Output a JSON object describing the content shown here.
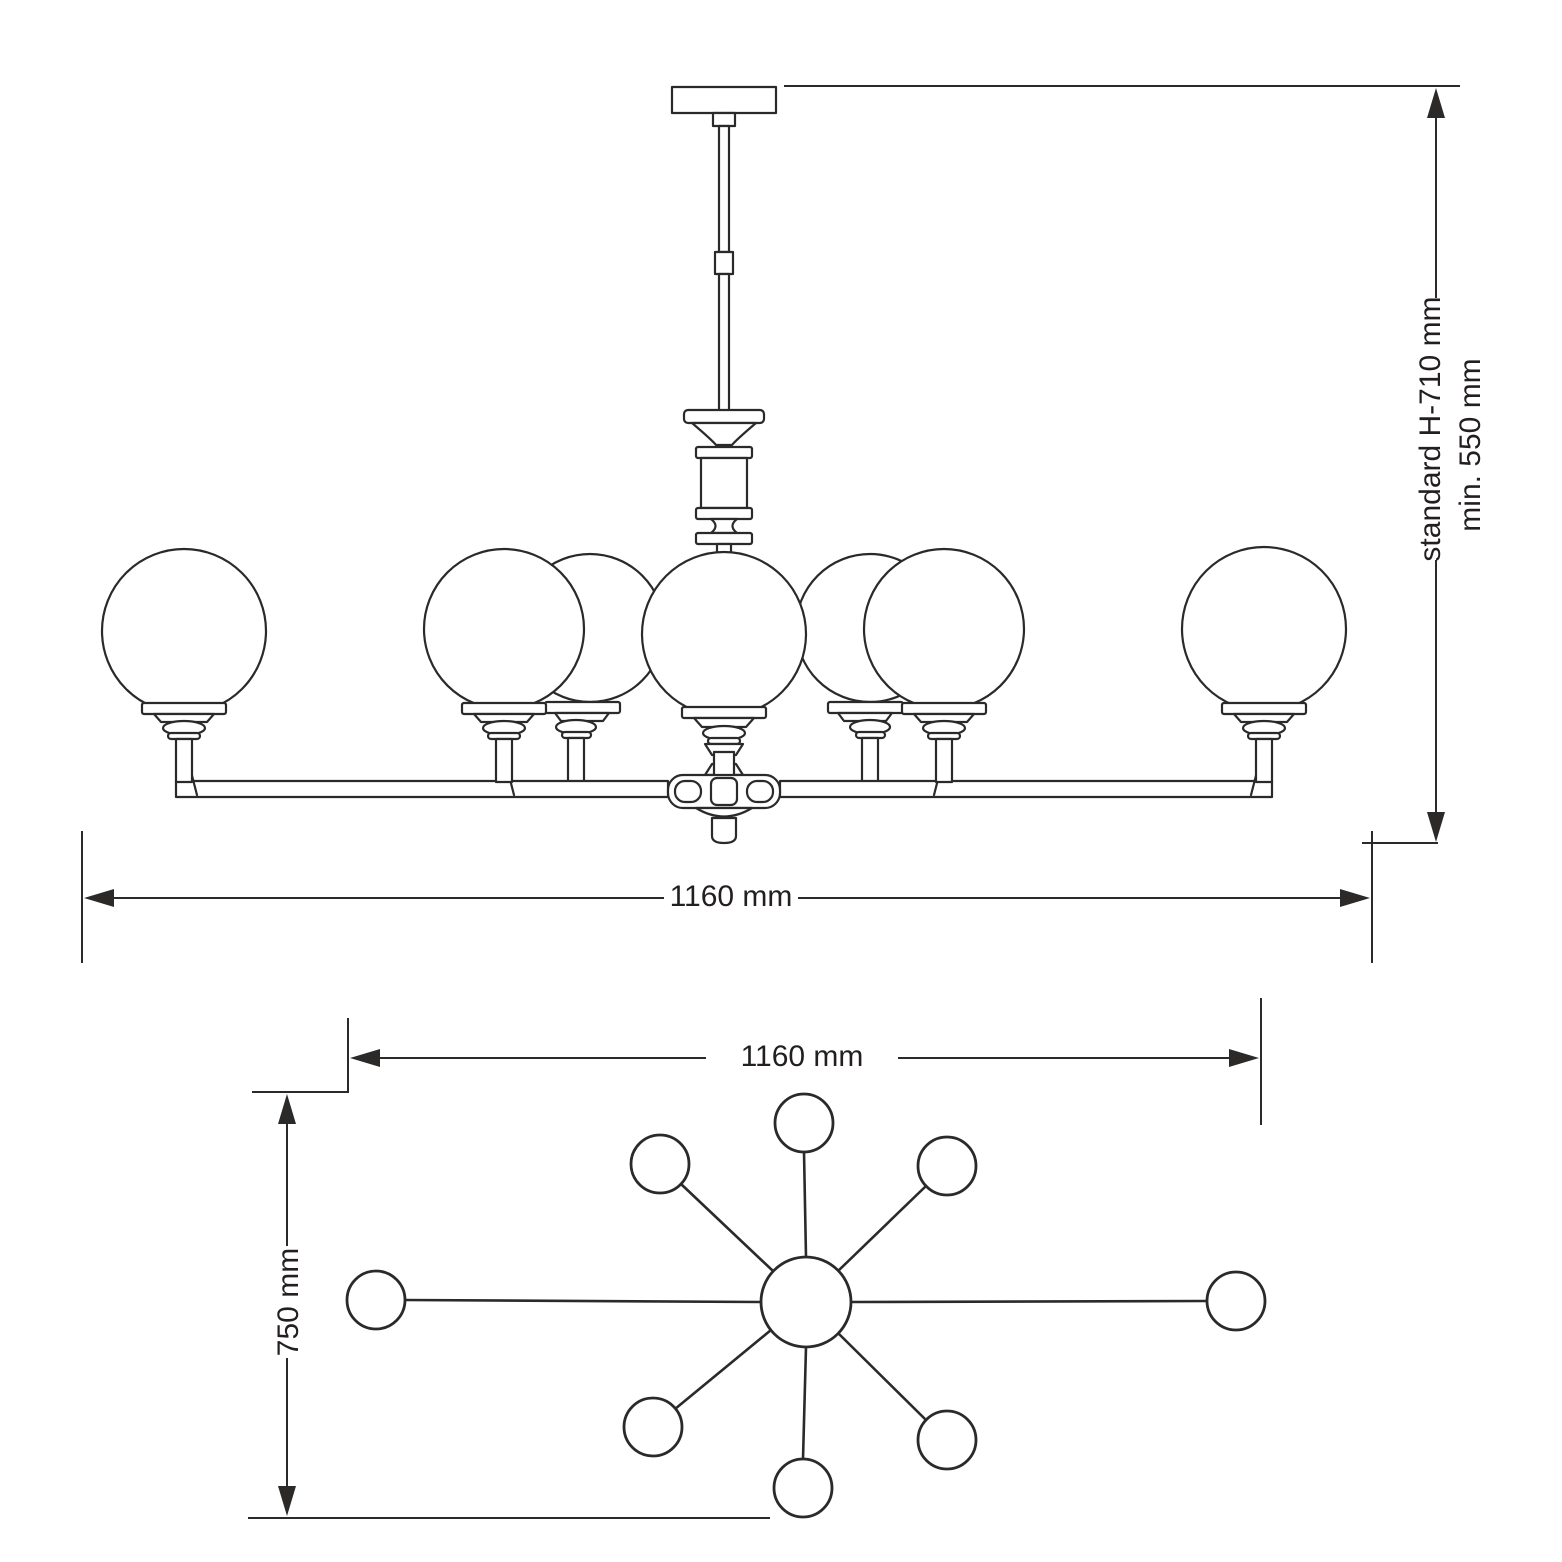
{
  "page": {
    "background": "#ffffff",
    "line_color": "#2b2a29",
    "text_color": "#231f20",
    "description": "Technical dimension drawing of an 8-arm globe chandelier, side elevation and plan view"
  },
  "drawing": {
    "elevation": {
      "width_label": "1160 mm",
      "height_standard_label": "standard H-710 mm",
      "height_min_label": "min. 550 mm",
      "visible_globe_count": 7
    },
    "plan": {
      "width_label": "1160 mm",
      "depth_label": "750 mm",
      "arm_count": 8
    }
  }
}
